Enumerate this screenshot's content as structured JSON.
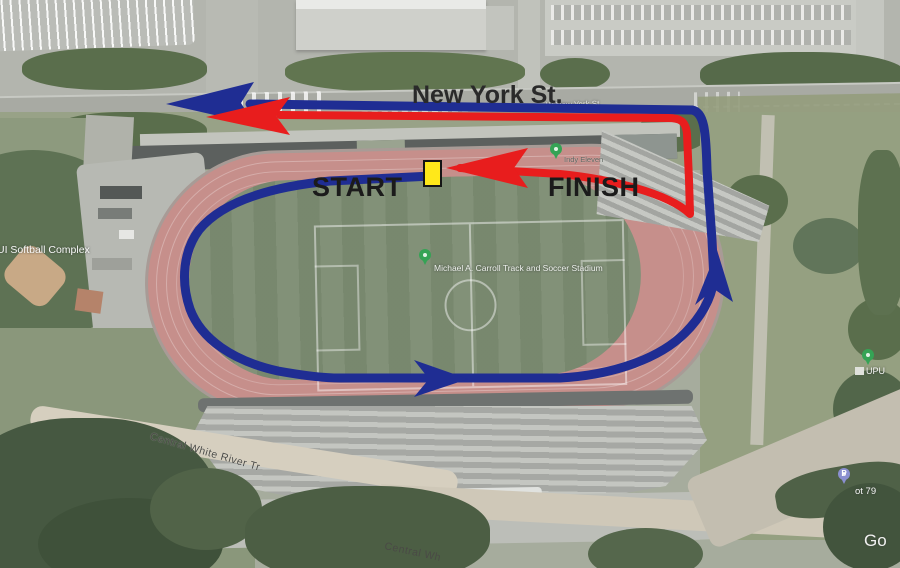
{
  "map_labels": {
    "street_main": "New York St.",
    "street_small": "W New York St",
    "stadium": "Michael A. Carroll Track and Soccer Stadium",
    "softball_complex": "PUI Softball Complex",
    "team": "Indy Eleven",
    "trail_upper": "Central White River Tr",
    "trail_lower": "Central Wh",
    "parking_lot": "ot 79",
    "parking_pin_letter": "P",
    "right_edge": "UPU",
    "watermark": "Go"
  },
  "route": {
    "start_label": "START",
    "finish_label": "FINISH",
    "outbound_color": "#1f2d93",
    "return_color": "#e81d1d",
    "marker_color": "#ffe81a"
  }
}
